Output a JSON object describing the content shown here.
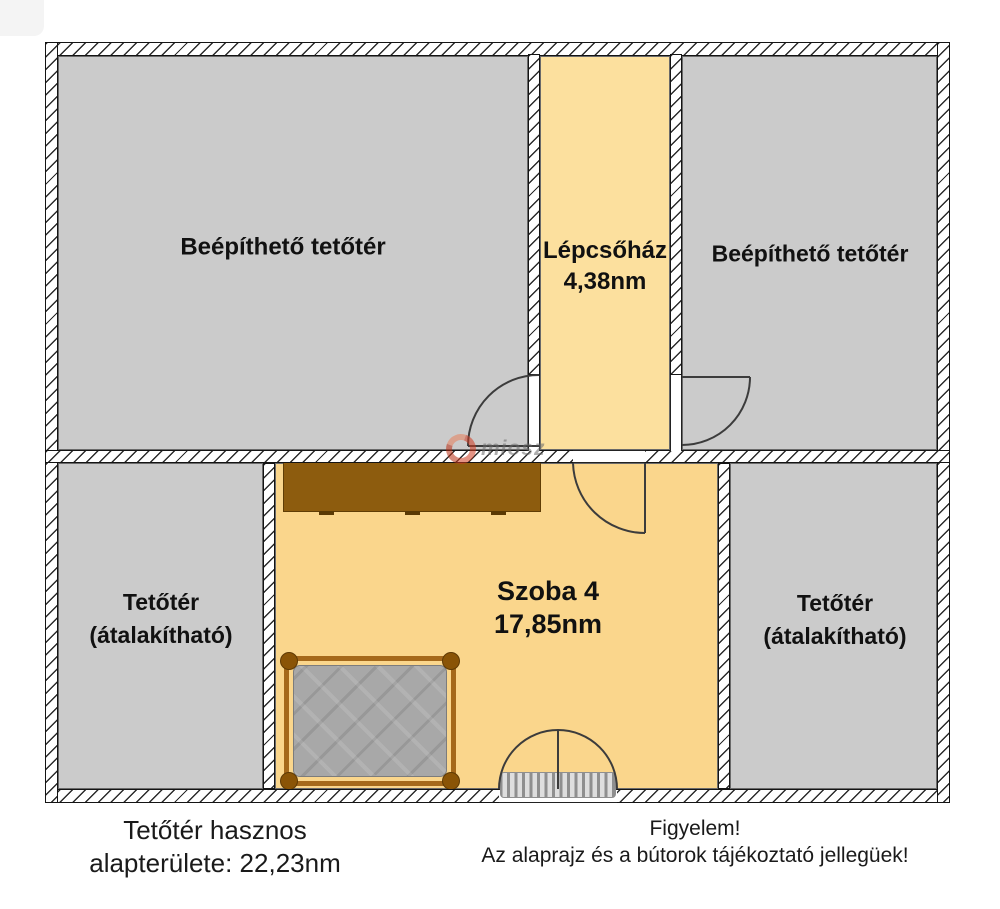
{
  "floorplan": {
    "rooms": [
      {
        "key": "attic-top-left",
        "label": "Beépíthető tetőtér"
      },
      {
        "key": "staircase",
        "label": "Lépcsőház",
        "area": "4,38nm"
      },
      {
        "key": "attic-top-right",
        "label": "Beépíthető tetőtér"
      },
      {
        "key": "attic-bottom-left",
        "label": "Tetőtér",
        "sublabel": "(átalakítható)"
      },
      {
        "key": "room-4",
        "label": "Szoba 4",
        "area": "17,85nm"
      },
      {
        "key": "attic-bottom-right",
        "label": "Tetőtér",
        "sublabel": "(átalakítható)"
      }
    ],
    "watermark": {
      "text": "miosz"
    },
    "colors": {
      "room_gray": "#cbcbcb",
      "staircase_yellow": "#fce09e",
      "room_yellow": "#fad68c",
      "wardrobe_brown": "#8d5c0e",
      "bed_frame_brown": "#a5691b",
      "mattress_gray": "#a8a8a8",
      "wall_hatch": "#2b2b2b",
      "watermark_red": "#cf3b21"
    }
  },
  "captions": {
    "left": {
      "line1": "Tetőtér hasznos",
      "line2": "alapterülete: 22,23nm"
    },
    "right": {
      "line1": "Figyelem!",
      "line2": "Az alaprajz és a bútorok tájékoztató jellegüek!"
    }
  }
}
